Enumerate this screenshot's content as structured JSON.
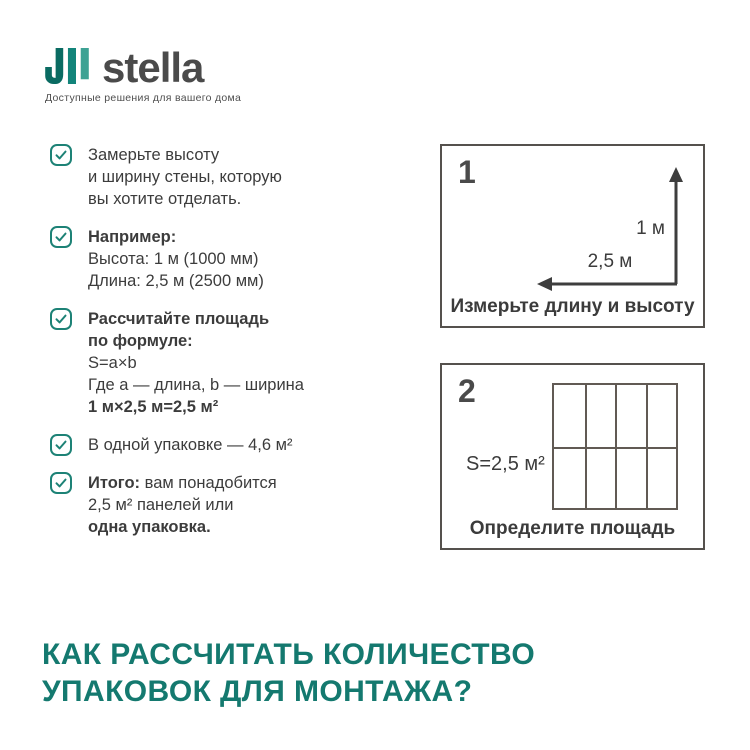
{
  "logo": {
    "brand": "stella",
    "tagline": "Доступные решения для вашего дома"
  },
  "checklist": {
    "items": [
      {
        "lines": [
          "Замерьте высоту",
          "и ширину стены, которую",
          "вы хотите отделать."
        ]
      },
      {
        "lines": [
          "Например:",
          "Высота: 1 м (1000 мм)",
          "Длина: 2,5 м (2500 мм)"
        ]
      },
      {
        "lines": [
          "Рассчитайте площадь",
          "по формуле:",
          "S=a×b",
          "Где a — длина, b — ширина",
          "1 м×2,5 м=2,5 м²"
        ]
      },
      {
        "lines": [
          "В одной упаковке — 4,6 м²"
        ]
      },
      {
        "lines": [
          "Итого:",
          " вам понадобится",
          "2,5 м² панелей или",
          "одна упаковка."
        ]
      }
    ]
  },
  "diagram1": {
    "number": "1",
    "height_label": "1 м",
    "length_label": "2,5 м",
    "caption": "Измерьте длину и высоту"
  },
  "diagram2": {
    "number": "2",
    "area_label": "S=2,5 м²",
    "caption": "Определите площадь",
    "panel_columns": 4,
    "panel_rows": 2
  },
  "heading": {
    "line1": "КАК РАССЧИТАТЬ КОЛИЧЕСТВО",
    "line2": "УПАКОВОК ДЛЯ МОНТАЖА?"
  },
  "colors": {
    "teal_accent": "#14796F",
    "logo_teal_dark": "#0A6B62",
    "logo_teal_mid": "#12847A",
    "logo_teal_light": "#3EA294",
    "text_dark": "#3C3C3C",
    "box_border": "#55514D",
    "grid_line": "#615A54"
  }
}
